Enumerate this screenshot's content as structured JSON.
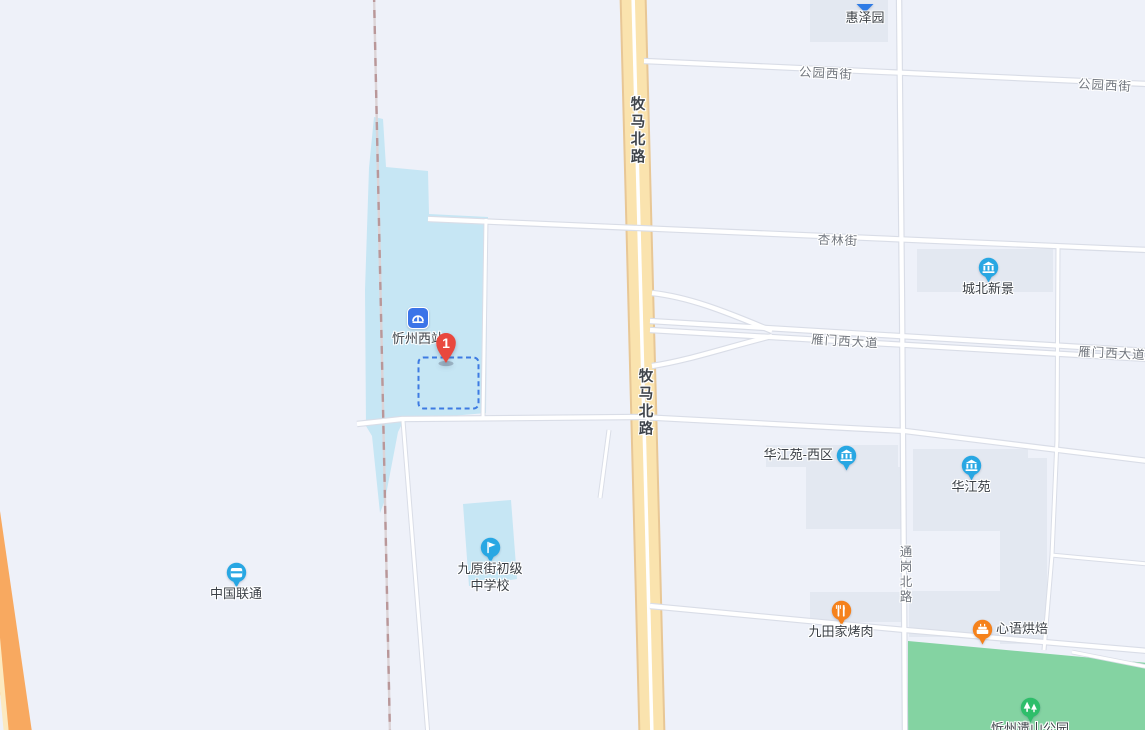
{
  "map": {
    "colors": {
      "background": "#EEF1F9",
      "building_block": "#E3E8F1",
      "area_blue": "#C6E6F4",
      "park_green": "#84D3A2",
      "road_fill": "#FFFFFF",
      "road_casing": "#D9DDE7",
      "main_road_yellow": "#FAE3AE",
      "main_road_border": "#E8C795",
      "highway_orange": "#F8A960",
      "highway_stripe": "#FCE9C0",
      "railway_dash": "#B99799",
      "selection_dash_blue": "#3D7BE2",
      "marker_red": "#E9483E",
      "poi_pin_blue": "#28A7E3",
      "station_square_blue": "#3B74E8",
      "poi_pin_orange": "#F5821C",
      "poi_pin_green": "#2EBE6A",
      "poi_label_color": "#3A3F45",
      "road_label_color": "#71767E"
    },
    "road_labels": [
      {
        "id": "gongyuan-west-street-1",
        "text": "公园西街",
        "x": 826,
        "y": 72,
        "rot": 3,
        "vertical": false,
        "major": false
      },
      {
        "id": "gongyuan-west-street-2",
        "text": "公园西街",
        "x": 1105,
        "y": 84,
        "rot": 3,
        "vertical": false,
        "major": false
      },
      {
        "id": "xinglin-street",
        "text": "杏林街",
        "x": 838,
        "y": 239,
        "rot": 2,
        "vertical": false,
        "major": false
      },
      {
        "id": "yanmen-west-avenue-1",
        "text": "雁门西大道",
        "x": 845,
        "y": 340,
        "rot": 3.5,
        "vertical": false,
        "major": false
      },
      {
        "id": "yanmen-west-avenue-2",
        "text": "雁门西大道",
        "x": 1112,
        "y": 352,
        "rot": 3,
        "vertical": false,
        "major": false
      },
      {
        "id": "muma-north-road-1",
        "text": "牧马北路",
        "x": 637,
        "y": 131,
        "rot": 0,
        "vertical": true,
        "major": true
      },
      {
        "id": "muma-north-road-2",
        "text": "牧马北路",
        "x": 645,
        "y": 403,
        "rot": 0,
        "vertical": true,
        "major": true
      },
      {
        "id": "tonggang-north-road",
        "text": "通岗北路",
        "x": 905,
        "y": 575,
        "rot": 0,
        "vertical": true,
        "major": false
      }
    ],
    "pois": [
      {
        "id": "huizeyuan",
        "label": "惠泽园",
        "icon": "pin-cut",
        "color": "#2E7BE5",
        "x": 865,
        "y": 0,
        "label_pos": "below"
      },
      {
        "id": "xinzhou-west-station",
        "label": "忻州西站",
        "icon": "railway-station",
        "color": "#3B74E8",
        "x": 418,
        "y": 318,
        "label_pos": "below"
      },
      {
        "id": "destination-marker",
        "label": "1",
        "icon": "red-marker",
        "color": "#E9483E",
        "x": 446,
        "y": 363,
        "label_pos": "inside"
      },
      {
        "id": "chengbei-xinjing",
        "label": "城北新景",
        "icon": "building",
        "color": "#28A7E3",
        "x": 988,
        "y": 267,
        "label_pos": "below"
      },
      {
        "id": "huajiangyuan-west",
        "label": "华江苑-西区",
        "icon": "building",
        "color": "#28A7E3",
        "x": 846,
        "y": 455,
        "label_pos": "left"
      },
      {
        "id": "huajiangyuan",
        "label": "华江苑",
        "icon": "building",
        "color": "#28A7E3",
        "x": 971,
        "y": 465,
        "label_pos": "below"
      },
      {
        "id": "china-unicom",
        "label": "中国联通",
        "icon": "shop",
        "color": "#28A7E3",
        "x": 236,
        "y": 572,
        "label_pos": "below"
      },
      {
        "id": "jiuyuan-street-middle-school",
        "label": "九原街初级中学校",
        "label_lines": [
          "九原街初级",
          "中学校"
        ],
        "icon": "school-flag",
        "color": "#28A7E3",
        "x": 490,
        "y": 547,
        "label_pos": "below"
      },
      {
        "id": "jiutianjia-bbq",
        "label": "九田家烤肉",
        "icon": "restaurant",
        "color": "#F5821C",
        "x": 841,
        "y": 610,
        "label_pos": "below"
      },
      {
        "id": "xinyu-bakery",
        "label": "心语烘焙",
        "icon": "bakery",
        "color": "#F5821C",
        "x": 982,
        "y": 629,
        "label_pos": "right"
      },
      {
        "id": "xinzhou-yishan-park",
        "label": "忻州遗山公园",
        "icon": "park-trees",
        "color": "#2EBE6A",
        "x": 1030,
        "y": 707,
        "label_pos": "below"
      }
    ]
  }
}
